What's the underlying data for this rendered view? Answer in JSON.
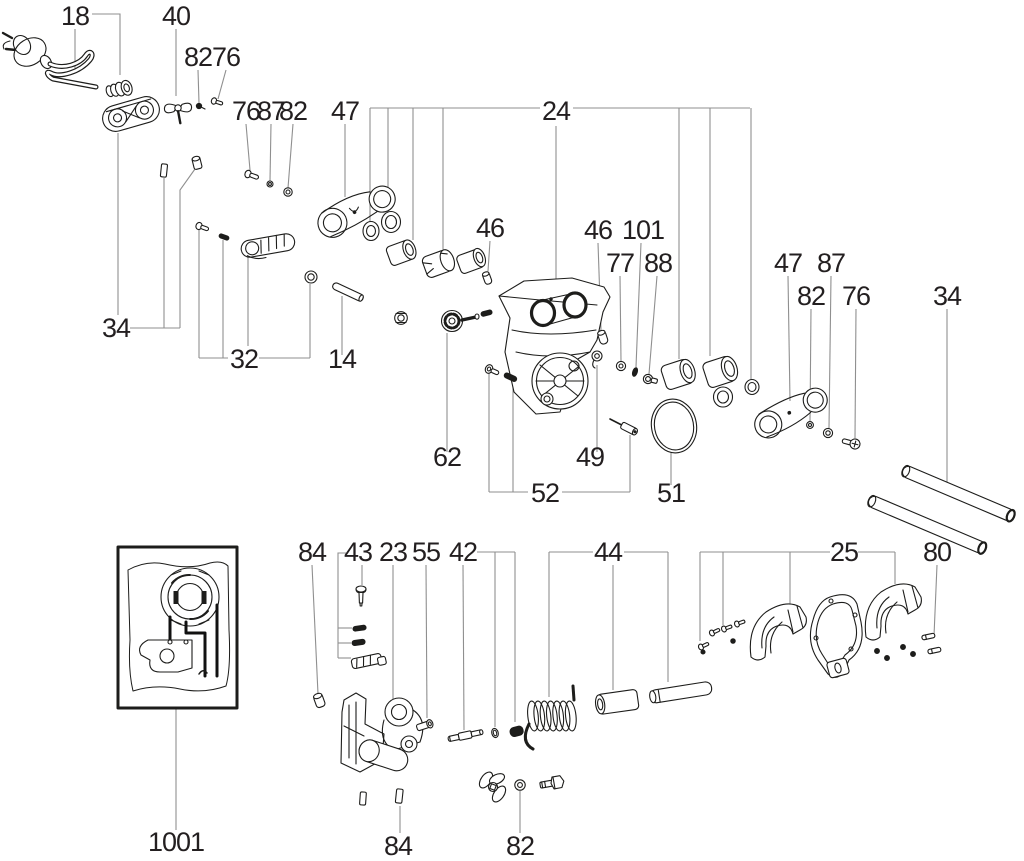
{
  "diagram": {
    "type": "exploded-parts-diagram",
    "canvas": {
      "width": 1024,
      "height": 861,
      "background": "#ffffff"
    },
    "colors": {
      "label": "#231f20",
      "leader": "#8f8f8f",
      "part_stroke": "#1d1d1b"
    },
    "labels": [
      {
        "text": "18",
        "x": 75,
        "y": 25,
        "part": "power-cord"
      },
      {
        "text": "40",
        "x": 176,
        "y": 25,
        "part": "wing-bolt"
      },
      {
        "text": "82",
        "x": 198,
        "y": 66,
        "part": "set-screw"
      },
      {
        "text": "76",
        "x": 226,
        "y": 66,
        "part": "screw"
      },
      {
        "text": "76",
        "x": 246,
        "y": 120,
        "part": "screw"
      },
      {
        "text": "87",
        "x": 271,
        "y": 120,
        "part": "washer"
      },
      {
        "text": "82",
        "x": 293,
        "y": 120,
        "part": "nut"
      },
      {
        "text": "47",
        "x": 345,
        "y": 120,
        "part": "link-plate"
      },
      {
        "text": "24",
        "x": 556,
        "y": 120,
        "part": "gear-housing"
      },
      {
        "text": "46",
        "x": 490,
        "y": 237,
        "part": "pin"
      },
      {
        "text": "46",
        "x": 598,
        "y": 239,
        "part": "pin"
      },
      {
        "text": "101",
        "x": 643,
        "y": 239,
        "part": "seal"
      },
      {
        "text": "77",
        "x": 620,
        "y": 272,
        "part": "washer"
      },
      {
        "text": "88",
        "x": 658,
        "y": 272,
        "part": "screw"
      },
      {
        "text": "47",
        "x": 788,
        "y": 272,
        "part": "link-plate"
      },
      {
        "text": "87",
        "x": 831,
        "y": 272,
        "part": "washer"
      },
      {
        "text": "82",
        "x": 811,
        "y": 305,
        "part": "washer"
      },
      {
        "text": "76",
        "x": 856,
        "y": 305,
        "part": "screw"
      },
      {
        "text": "34",
        "x": 947,
        "y": 305,
        "part": "guide-rods"
      },
      {
        "text": "34",
        "x": 116,
        "y": 337,
        "part": "cable-clamp"
      },
      {
        "text": "32",
        "x": 244,
        "y": 368,
        "part": "lock-lever"
      },
      {
        "text": "14",
        "x": 342,
        "y": 368,
        "part": "pin"
      },
      {
        "text": "62",
        "x": 447,
        "y": 466,
        "part": "knob"
      },
      {
        "text": "49",
        "x": 590,
        "y": 466,
        "part": "retaining-clip"
      },
      {
        "text": "52",
        "x": 545,
        "y": 502,
        "part": "pin-set"
      },
      {
        "text": "51",
        "x": 671,
        "y": 502,
        "part": "o-ring"
      },
      {
        "text": "84",
        "x": 312,
        "y": 561,
        "part": "pin"
      },
      {
        "text": "43",
        "x": 358,
        "y": 561,
        "part": "latch-kit"
      },
      {
        "text": "23",
        "x": 393,
        "y": 561,
        "part": "pivot-bracket"
      },
      {
        "text": "55",
        "x": 426,
        "y": 561,
        "part": "screw"
      },
      {
        "text": "42",
        "x": 463,
        "y": 561,
        "part": "stepped-pin"
      },
      {
        "text": "44",
        "x": 608,
        "y": 561,
        "part": "spring-kit"
      },
      {
        "text": "25",
        "x": 844,
        "y": 561,
        "part": "handle-set"
      },
      {
        "text": "80",
        "x": 937,
        "y": 561,
        "part": "pin"
      },
      {
        "text": "1001",
        "x": 176,
        "y": 851,
        "part": "wiring-diagram"
      },
      {
        "text": "84",
        "x": 398,
        "y": 855,
        "part": "pin"
      },
      {
        "text": "82",
        "x": 520,
        "y": 855,
        "part": "washer"
      }
    ],
    "leaders": [
      {
        "points": "75,29 75,70"
      },
      {
        "points": "92,14 120,14 120,75"
      },
      {
        "points": "176,29 176,96"
      },
      {
        "points": "198,70 199,103"
      },
      {
        "points": "226,70 218,99"
      },
      {
        "points": "246,124 250,170"
      },
      {
        "points": "271,124 270,181"
      },
      {
        "points": "293,124 288,188"
      },
      {
        "points": "345,124 345,197"
      },
      {
        "points": "370,108 540,108"
      },
      {
        "points": "573,108 750,108"
      },
      {
        "points": "370,108 370,221"
      },
      {
        "points": "388,108 388,212"
      },
      {
        "points": "413,108 413,240"
      },
      {
        "points": "443,108 443,250"
      },
      {
        "points": "556,126 556,286"
      },
      {
        "points": "679,108 679,359"
      },
      {
        "points": "710,108 710,356"
      },
      {
        "points": "751,108 751,379"
      },
      {
        "points": "490,241 488,271"
      },
      {
        "points": "598,243 601,330"
      },
      {
        "points": "641,243 636,367"
      },
      {
        "points": "620,276 621,361"
      },
      {
        "points": "657,276 649,374"
      },
      {
        "points": "788,276 790,401"
      },
      {
        "points": "831,276 829,428"
      },
      {
        "points": "811,309 810,421"
      },
      {
        "points": "856,309 855,438"
      },
      {
        "points": "947,309 947,486"
      },
      {
        "points": "118,133 118,315"
      },
      {
        "points": "130,328 180,328"
      },
      {
        "points": "164,328 164,178"
      },
      {
        "points": "180,328 180,190 195,169"
      },
      {
        "points": "199,358 228,358"
      },
      {
        "points": "199,358 199,229"
      },
      {
        "points": "223,358 223,240"
      },
      {
        "points": "259,358 310,358"
      },
      {
        "points": "310,358 310,284"
      },
      {
        "points": "248,346 248,257"
      },
      {
        "points": "342,355 342,296"
      },
      {
        "points": "447,452 447,333"
      },
      {
        "points": "597,452 597,365"
      },
      {
        "points": "489,492 528,492"
      },
      {
        "points": "562,492 630,492"
      },
      {
        "points": "489,492 489,373"
      },
      {
        "points": "513,492 513,381"
      },
      {
        "points": "630,492 630,435"
      },
      {
        "points": "671,485 671,453"
      },
      {
        "points": "312,565 318,694"
      },
      {
        "points": "362,565 362,585"
      },
      {
        "points": "346,553 338,553 338,658"
      },
      {
        "points": "338,628 352,628"
      },
      {
        "points": "338,643 351,643"
      },
      {
        "points": "338,658 351,658"
      },
      {
        "points": "393,565 393,699"
      },
      {
        "points": "426,565 427,718"
      },
      {
        "points": "463,565 464,730"
      },
      {
        "points": "477,552 515,552"
      },
      {
        "points": "495,552 495,727"
      },
      {
        "points": "515,552 515,722"
      },
      {
        "points": "549,552 593,552"
      },
      {
        "points": "624,552 668,552"
      },
      {
        "points": "549,552 549,697"
      },
      {
        "points": "613,565 613,690"
      },
      {
        "points": "668,552 668,682"
      },
      {
        "points": "700,552 830,552"
      },
      {
        "points": "858,552 895,552"
      },
      {
        "points": "700,552 700,641"
      },
      {
        "points": "723,552 723,625"
      },
      {
        "points": "790,552 790,604"
      },
      {
        "points": "895,552 895,584"
      },
      {
        "points": "937,565 934,636"
      },
      {
        "points": "176,708 176,830"
      },
      {
        "points": "400,833 400,806"
      },
      {
        "points": "520,833 520,791"
      }
    ]
  }
}
